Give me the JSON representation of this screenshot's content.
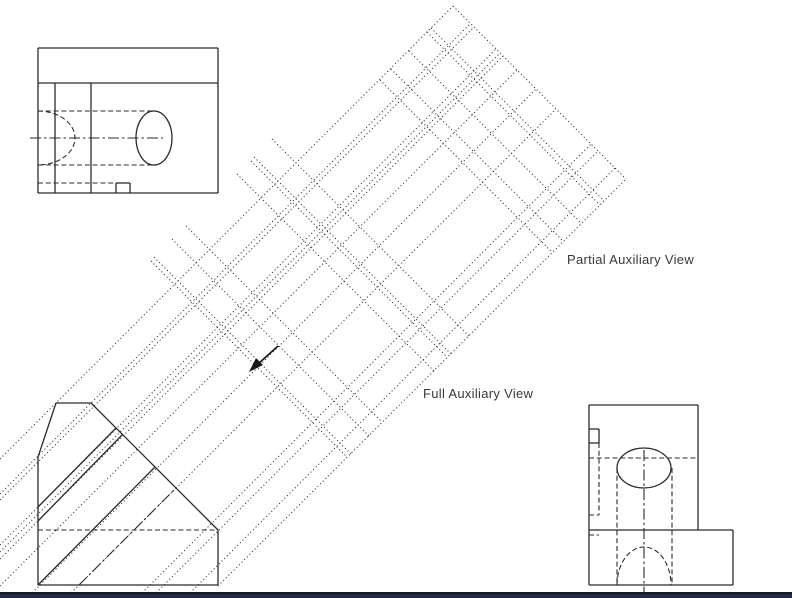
{
  "page": {
    "background": "#ffffff",
    "stroke_color": "#2b2b2b",
    "footer": {
      "line_color": "#181818",
      "bar_color": "#232a46",
      "line_y": 592,
      "bar_y": 594
    }
  },
  "labels": {
    "partial": {
      "text": "Partial Auxiliary View",
      "x": 567,
      "y": 253,
      "size": 13
    },
    "full": {
      "text": "Full Auxiliary View",
      "x": 423,
      "y": 387,
      "size": 13
    }
  },
  "drawing": {
    "views": {
      "top_view": {
        "solid": [
          [
            38,
            48,
            218,
            48
          ],
          [
            218,
            48,
            218,
            193
          ],
          [
            218,
            193,
            38,
            193
          ],
          [
            38,
            193,
            38,
            48
          ],
          [
            38,
            83,
            218,
            83
          ],
          [
            55,
            83,
            55,
            193
          ],
          [
            91,
            83,
            91,
            193
          ],
          [
            116,
            183,
            130,
            183
          ],
          [
            116,
            183,
            116,
            193
          ],
          [
            130,
            183,
            130,
            193
          ]
        ],
        "dashed": [
          [
            38,
            111,
            154,
            111
          ],
          [
            38,
            165,
            154,
            165
          ],
          [
            38,
            183,
            116,
            183
          ]
        ],
        "dashdot": [
          [
            30,
            138,
            163,
            138
          ]
        ],
        "ellipses": [
          {
            "cx": 154,
            "cy": 138,
            "rx": 18,
            "ry": 27,
            "style": "solid",
            "name": "hole-ellipse-top-view"
          }
        ],
        "arcs": [
          {
            "d": "M 38 111 A 37 27 0 0 1 38 165",
            "style": "dashed",
            "name": "hidden-bore-arc-top-view"
          }
        ]
      },
      "front_view": {
        "solid": [
          [
            38,
            457,
            56,
            403
          ],
          [
            56,
            403,
            91,
            403
          ],
          [
            91,
            403,
            218,
            530
          ],
          [
            218,
            530,
            218,
            585
          ],
          [
            218,
            585,
            38,
            585
          ],
          [
            38,
            585,
            38,
            457
          ],
          [
            38,
            507,
            116,
            428
          ],
          [
            38,
            521,
            123,
            434
          ],
          [
            38,
            585,
            155,
            467
          ]
        ],
        "dashed": [
          [
            38,
            530,
            218,
            530
          ]
        ],
        "dashdot": [
          [
            79,
            585,
            176,
            488
          ]
        ],
        "ellipses": [],
        "arcs": []
      },
      "side_view": {
        "solid": [
          [
            589,
            405,
            698,
            405
          ],
          [
            698,
            405,
            698,
            530
          ],
          [
            589,
            405,
            589,
            530
          ],
          [
            589,
            530,
            733,
            530
          ],
          [
            733,
            530,
            733,
            585
          ],
          [
            733,
            585,
            589,
            585
          ],
          [
            589,
            585,
            589,
            530
          ],
          [
            589,
            429,
            599,
            429
          ],
          [
            599,
            429,
            599,
            443
          ],
          [
            599,
            443,
            589,
            443
          ]
        ],
        "dashed": [
          [
            589,
            458,
            698,
            458
          ],
          [
            617,
            468,
            617,
            585
          ],
          [
            672,
            468,
            672,
            585
          ],
          [
            599,
            443,
            599,
            515
          ],
          [
            589,
            515,
            599,
            515
          ],
          [
            589,
            535,
            599,
            535
          ]
        ],
        "dashdot": [
          [
            644,
            450,
            644,
            592
          ]
        ],
        "ellipses": [
          {
            "cx": 644,
            "cy": 468,
            "rx": 27,
            "ry": 20,
            "style": "solid",
            "name": "hole-ellipse-side-view"
          }
        ],
        "arcs": [
          {
            "d": "M 617 585 A 27 38 0 0 1 671 585",
            "style": "dashed",
            "name": "hidden-bore-arc-side-view"
          }
        ]
      }
    },
    "projection": {
      "dotted": [
        [
          0,
          459,
          453,
          6
        ],
        [
          0,
          494,
          470,
          24
        ],
        [
          0,
          500,
          474,
          27
        ],
        [
          0,
          545,
          496,
          49
        ],
        [
          0,
          552,
          500,
          53
        ],
        [
          0,
          559,
          503,
          56
        ],
        [
          0,
          586,
          517,
          70
        ],
        [
          27,
          598,
          536,
          89
        ],
        [
          66,
          598,
          556,
          109
        ],
        [
          137,
          598,
          591,
          144
        ],
        [
          151,
          598,
          598,
          151
        ],
        [
          185,
          598,
          615,
          168
        ],
        [
          218,
          586,
          626,
          179
        ],
        [
          453,
          6,
          626,
          179
        ],
        [
          431,
          28,
          604,
          201
        ],
        [
          427,
          32,
          600,
          205
        ],
        [
          409,
          51,
          581,
          223
        ],
        [
          391,
          69,
          563,
          241
        ],
        [
          380,
          80,
          552,
          252
        ],
        [
          272,
          139,
          469,
          336
        ],
        [
          254,
          157,
          451,
          354
        ],
        [
          251,
          161,
          447,
          357
        ],
        [
          237,
          174,
          434,
          371
        ],
        [
          186,
          226,
          382,
          422
        ],
        [
          172,
          239,
          369,
          436
        ],
        [
          154,
          257,
          351,
          454
        ],
        [
          151,
          261,
          347,
          457
        ]
      ]
    },
    "arrow": {
      "line": [
        278,
        346,
        258,
        364
      ],
      "head_points": "249,372 263,365 256,358"
    }
  }
}
